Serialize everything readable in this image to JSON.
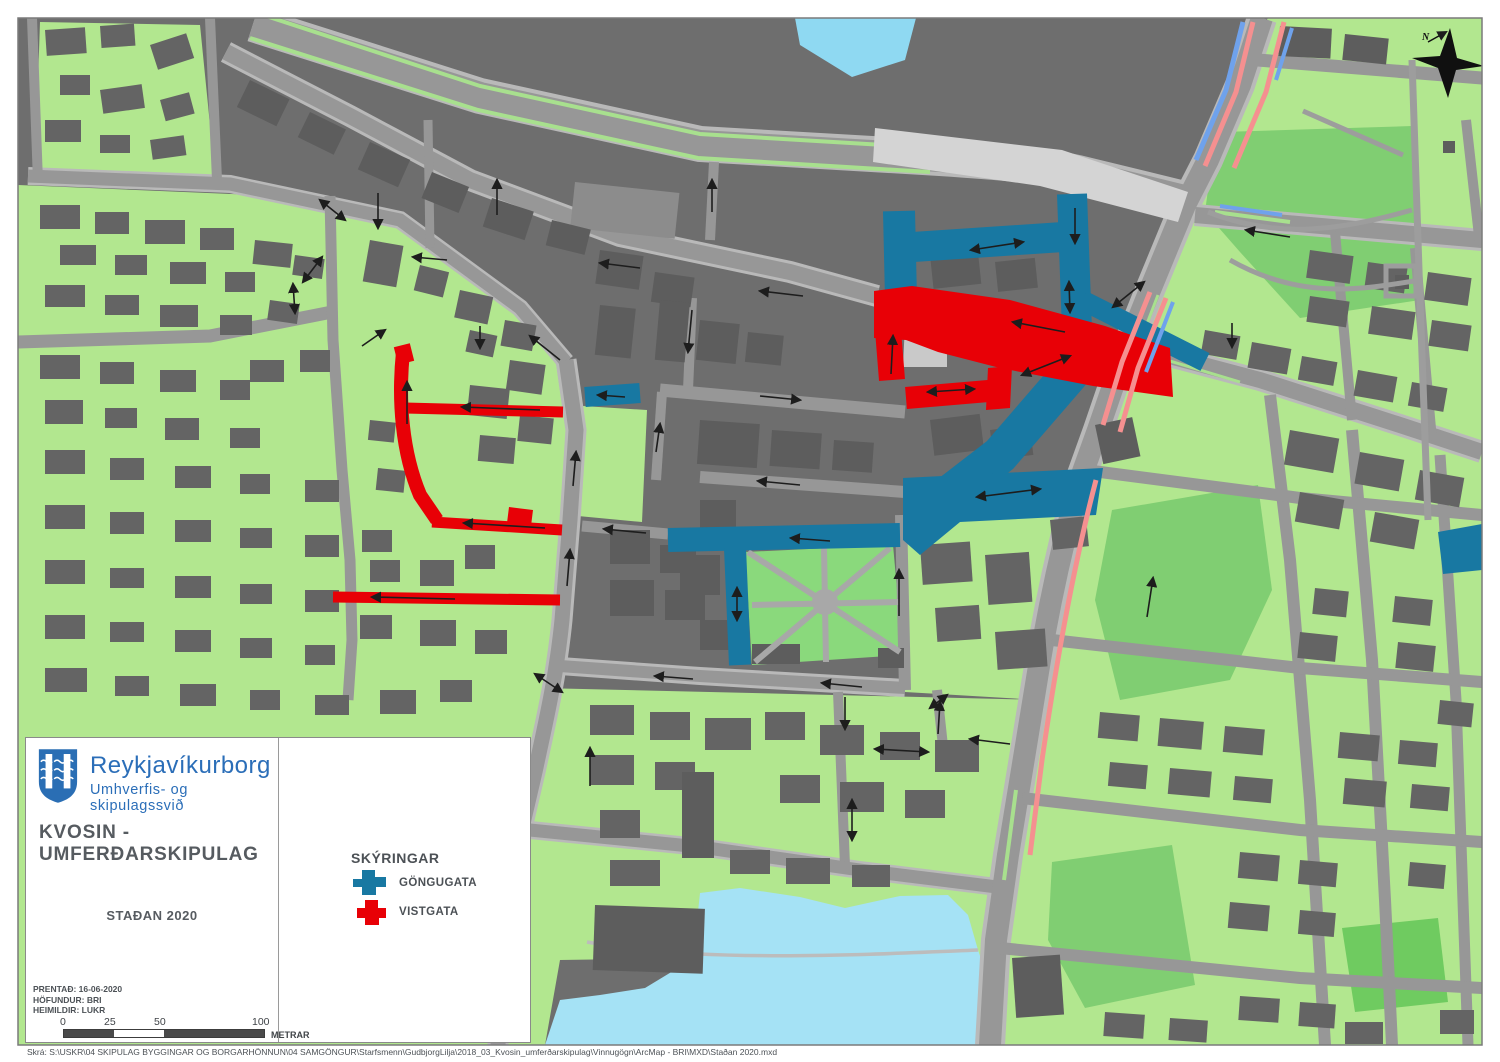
{
  "title_block": {
    "org_name": "Reykjavíkurborg",
    "org_department": "Umhverfis- og skipulagssvið",
    "map_title": "KVOSIN - UMFERÐARSKIPULAG",
    "status_label": "STAÐAN 2020",
    "print_info": [
      "PRENTAÐ: 16-06-2020",
      "HÖFUNDUR: BRI",
      "HEIMILDIR: LUKR"
    ]
  },
  "legend": {
    "heading": "SKÝRINGAR",
    "items": [
      {
        "label": "GÖNGUGATA",
        "color": "#1878A2"
      },
      {
        "label": "VISTGATA",
        "color": "#E80006"
      }
    ]
  },
  "scale_bar": {
    "ticks": [
      "0",
      "25",
      "50",
      "100"
    ],
    "unit": "METRAR"
  },
  "compass": {
    "label": "N"
  },
  "map_colors": {
    "pedestrian_street_blue": "#1878A2",
    "living_street_red": "#E80006",
    "bus_lane_pink": "#F59090",
    "bike_lane_blue": "#6FA2EC",
    "water": "#9FDFF4",
    "park_green": "#80CE72",
    "parcel_green": "#B2E78F",
    "building_gray": "#646464",
    "road_gray": "#979797",
    "plaza_light": "#D4D4D4"
  },
  "footer": {
    "file_path": "Skrá: S:\\USKR\\04 SKIPULAG BYGGINGAR OG BORGARHÖNNUN\\04 SAMGÖNGUR\\Starfsmenn\\GudbjorgLilja\\2018_03_Kvosin_umferðarskipulag\\Vinnugögn\\ArcMap - BRI\\MXD\\Staðan 2020.mxd"
  }
}
